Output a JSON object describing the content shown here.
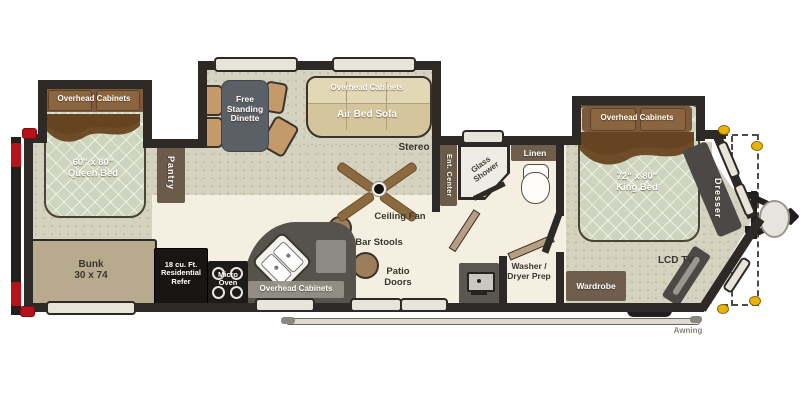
{
  "colors": {
    "wall": "#2d2926",
    "carpet": "#d6d2c0",
    "hard_floor": "#f4efe1",
    "cabinet_brown": "#6f5e4b",
    "bed_cabinet_brown": "#7d5a3c",
    "counter_gray": "#56534c",
    "blanket_brown": "#6f4c28",
    "accent_red": "#b5121b",
    "marker_amber": "#eab308",
    "upholstery_tan": "#c49a6a"
  },
  "rear_bedroom": {
    "overhead_cabinets": "Overhead Cabinets",
    "bed_size": "60\" x 80\"",
    "bed_type": "Queen Bed",
    "bunk_name": "Bunk",
    "bunk_size": "30 x 74",
    "pantry": "Pantry"
  },
  "living": {
    "dinette_l1": "Free",
    "dinette_l2": "Standing",
    "dinette_l3": "Dinette",
    "sofa_overhead": "Overhead Cabinets",
    "sofa": "Air Bed Sofa",
    "stereo": "Stereo",
    "ceiling_fan": "Ceiling Fan",
    "bar_stools": "Bar Stools",
    "patio_l1": "Patio",
    "patio_l2": "Doors",
    "ent_center": "Ent. Center"
  },
  "kitchen": {
    "refer_l1": "18 cu. Ft.",
    "refer_l2": "Residential",
    "refer_l3": "Refer",
    "micro_l1": "Micro",
    "micro_l2": "Oven",
    "overhead_cabinets": "Overhead Cabinets"
  },
  "bathroom": {
    "shower_l1": "Glass",
    "shower_l2": "Shower",
    "linen": "Linen",
    "washer_l1": "Washer /",
    "washer_l2": "Dryer Prep"
  },
  "front_bedroom": {
    "overhead_cabinets": "Overhead Cabinets",
    "bed_size": "72\" x 80\"",
    "bed_type": "King Bed",
    "wardrobe": "Wardrobe",
    "dresser": "Dresser",
    "lcd_tv": "LCD TV"
  },
  "exterior": {
    "awning": "Awning"
  }
}
